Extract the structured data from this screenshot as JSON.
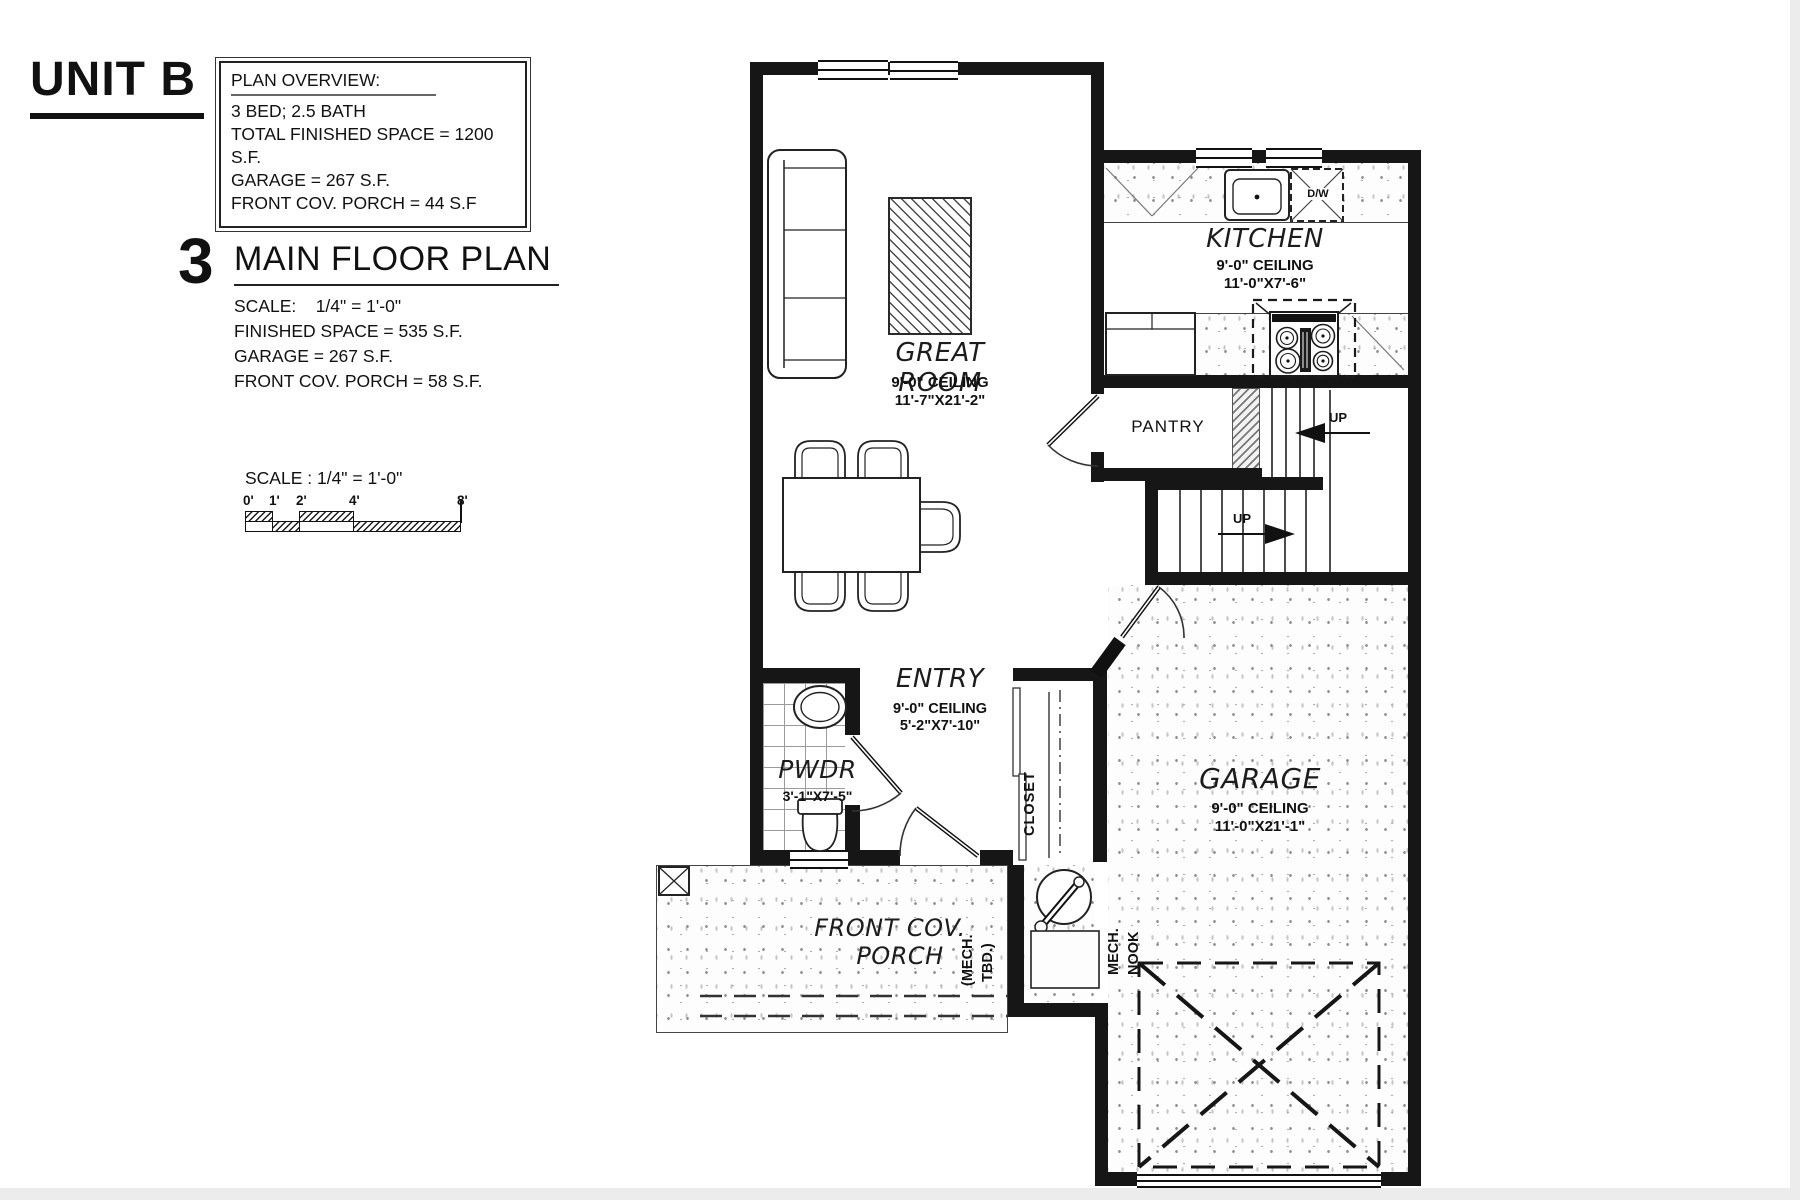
{
  "colors": {
    "wall": "#161616",
    "paper": "#ffffff",
    "hatch": "#4a4a4a"
  },
  "header": {
    "unit_title": "UNIT B"
  },
  "plan_overview": {
    "title": "PLAN OVERVIEW:",
    "lines": [
      "3 BED; 2.5 BATH",
      "TOTAL FINISHED SPACE = 1200 S.F.",
      "GARAGE = 267 S.F.",
      "FRONT COV. PORCH = 44 S.F"
    ]
  },
  "plan_heading": {
    "number": "3",
    "title": "MAIN FLOOR PLAN",
    "scale_line": "SCALE:    1/4\" = 1'-0\"",
    "details": [
      "FINISHED SPACE = 535 S.F.",
      "GARAGE = 267 S.F.",
      "FRONT COV. PORCH = 58 S.F."
    ]
  },
  "scale_bar": {
    "title": "SCALE : 1/4\" = 1'-0\"",
    "ticks": [
      "0'",
      "1'",
      "2'",
      "4'",
      "8'"
    ]
  },
  "rooms": {
    "great_room": {
      "name": "GREAT ROOM",
      "ceiling": "9'-0\" CEILING",
      "dims": "11'-7\"X21'-2\""
    },
    "kitchen": {
      "name": "KITCHEN",
      "ceiling": "9'-0\" CEILING",
      "dims": "11'-0\"X7'-6\""
    },
    "pantry": {
      "name": "PANTRY"
    },
    "entry": {
      "name": "ENTRY",
      "ceiling": "9'-0\" CEILING",
      "dims": "5'-2\"X7'-10\""
    },
    "pwdr": {
      "name": "PWDR",
      "dims": "3'-1\"X7'-5\""
    },
    "closet": {
      "name": "CLOSET"
    },
    "garage": {
      "name": "GARAGE",
      "ceiling": "9'-0\" CEILING",
      "dims": "11'-0\"X21'-1\""
    },
    "porch": {
      "name_line1": "FRONT COV.",
      "name_line2": "PORCH"
    },
    "mech_tbd": {
      "line1": "(MECH.",
      "line2": "TBD.)"
    },
    "mech_nook": {
      "line1": "MECH.",
      "line2": "NOOK"
    }
  },
  "annotations": {
    "up_upper": "UP",
    "up_lower": "UP",
    "dishwasher": "D/W"
  }
}
